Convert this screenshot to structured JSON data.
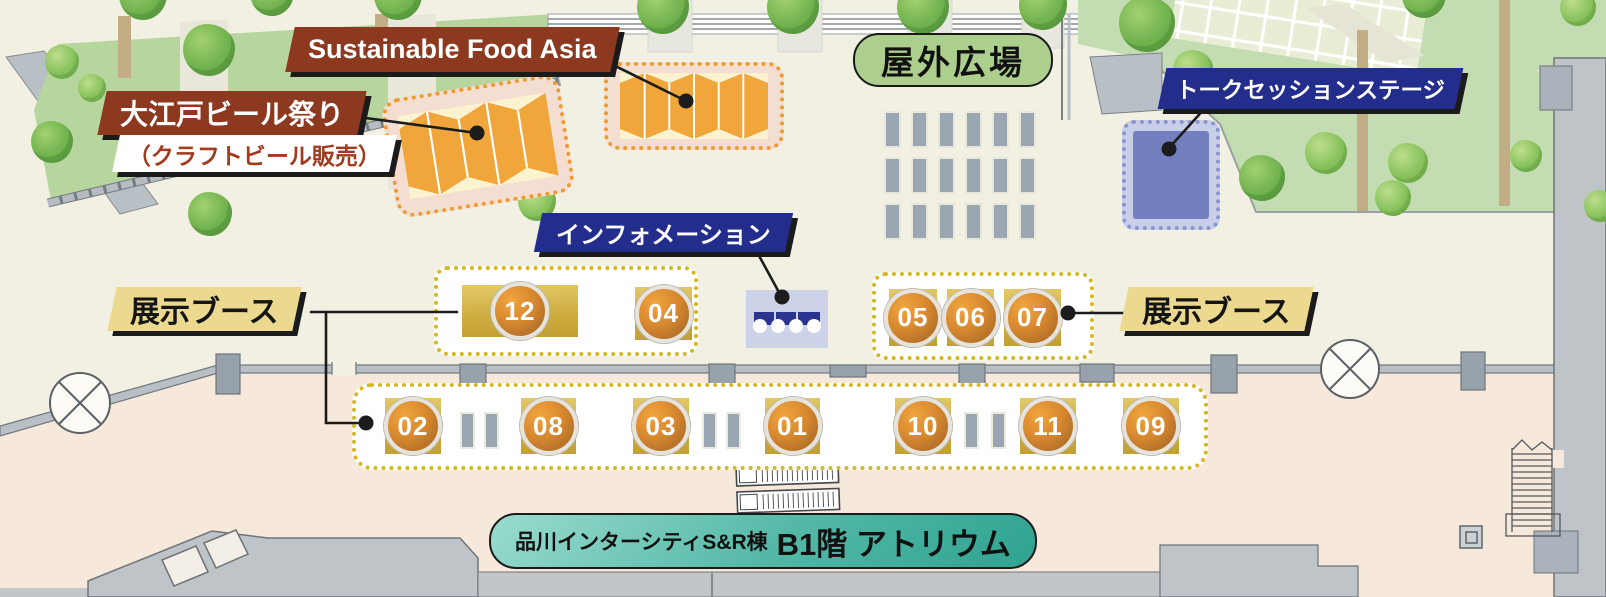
{
  "banners": {
    "sustainable_food_asia": {
      "label": "Sustainable Food Asia"
    },
    "oedo_beer": {
      "title": "大江戸ビール祭り",
      "subtitle": "（クラフトビール販売）"
    },
    "information": {
      "label": "インフォメーション"
    },
    "talk_session_stage": {
      "label": "トークセッションステージ"
    },
    "outdoor_plaza": {
      "label": "屋外広場"
    },
    "exhibition_booth_left": {
      "label": "展示ブース"
    },
    "exhibition_booth_right": {
      "label": "展示ブース"
    },
    "venue": {
      "building": "品川インターシティS&R棟",
      "floor": "B1階 アトリウム"
    }
  },
  "booths": {
    "upper_left_row": [
      {
        "num": "12"
      },
      {
        "num": "04"
      }
    ],
    "upper_right_row": [
      {
        "num": "05"
      },
      {
        "num": "06"
      },
      {
        "num": "07"
      }
    ],
    "bottom_row": [
      {
        "num": "02"
      },
      {
        "num": "08"
      },
      {
        "num": "03"
      },
      {
        "num": "01"
      },
      {
        "num": "10"
      },
      {
        "num": "11"
      },
      {
        "num": "09"
      }
    ]
  },
  "plaza": {
    "bench_rows": 3,
    "bench_columns": 6
  },
  "icons": {
    "tent": "accordion-canopy-tent",
    "stage": "stage-platform",
    "information_desk": "reception-counter",
    "escalator": "escalator",
    "stairs": "staircase",
    "structural_column": "circle-x-column",
    "bench": "bench-marker",
    "tree": "tree",
    "bush": "bush"
  },
  "colors": {
    "banner_brown": "#8c3920",
    "banner_navy": "#232e8c",
    "label_green": "#adcf8e",
    "label_yellow": "#ead98f",
    "venue_teal": "#2fa391",
    "booth_gold": "#cdac3f",
    "badge_orange": "#d8892f",
    "dotted_yellow": "#d6b71f",
    "dotted_orange": "#ef9a30",
    "stage_blue": "#737fbe",
    "floor_upper": "#f2efe3",
    "floor_lower": "#f6e8da",
    "lawn_green": "#c4dcb2",
    "wall_gray": "#b8bfc5"
  }
}
